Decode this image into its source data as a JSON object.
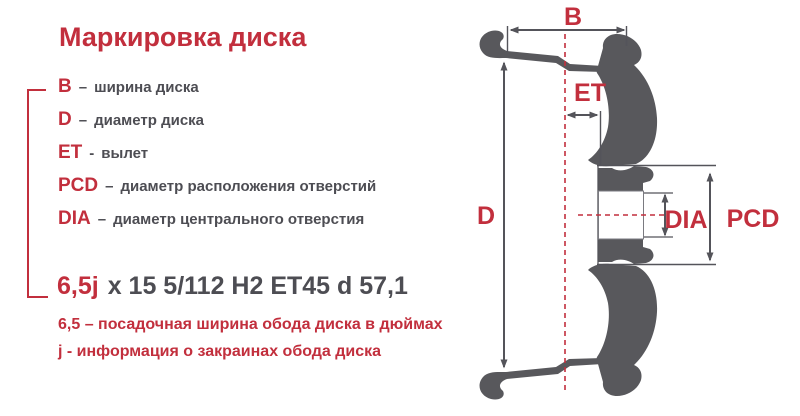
{
  "colors": {
    "accent_red": "#c22f3d",
    "text_dark": "#4d4d53",
    "wheel_gray": "#58585c",
    "dim_line_gray": "#54545a",
    "background": "#ffffff"
  },
  "title": "Маркировка диска",
  "legend": {
    "items": [
      {
        "term": "B",
        "sep": "–",
        "desc": "ширина диска"
      },
      {
        "term": "D",
        "sep": "–",
        "desc": "диаметр диска"
      },
      {
        "term": "ET",
        "sep": "-",
        "desc": "вылет"
      },
      {
        "term": "PCD",
        "sep": "–",
        "desc": "диаметр расположения отверстий"
      },
      {
        "term": "DIA",
        "sep": "–",
        "desc": "диаметр центрального отверстия"
      }
    ]
  },
  "marking": {
    "highlight": "6,5j",
    "rest": "x 15 5/112 H2 ET45 d 57,1"
  },
  "notes": [
    "6,5 – посадочная ширина обода диска в дюймах",
    "j - информация о закраинах обода диска"
  ],
  "diagram": {
    "labels": {
      "width": "B",
      "offset": "ET",
      "diameter": "D",
      "center_bore": "DIA",
      "bolt_circle": "PCD"
    }
  }
}
